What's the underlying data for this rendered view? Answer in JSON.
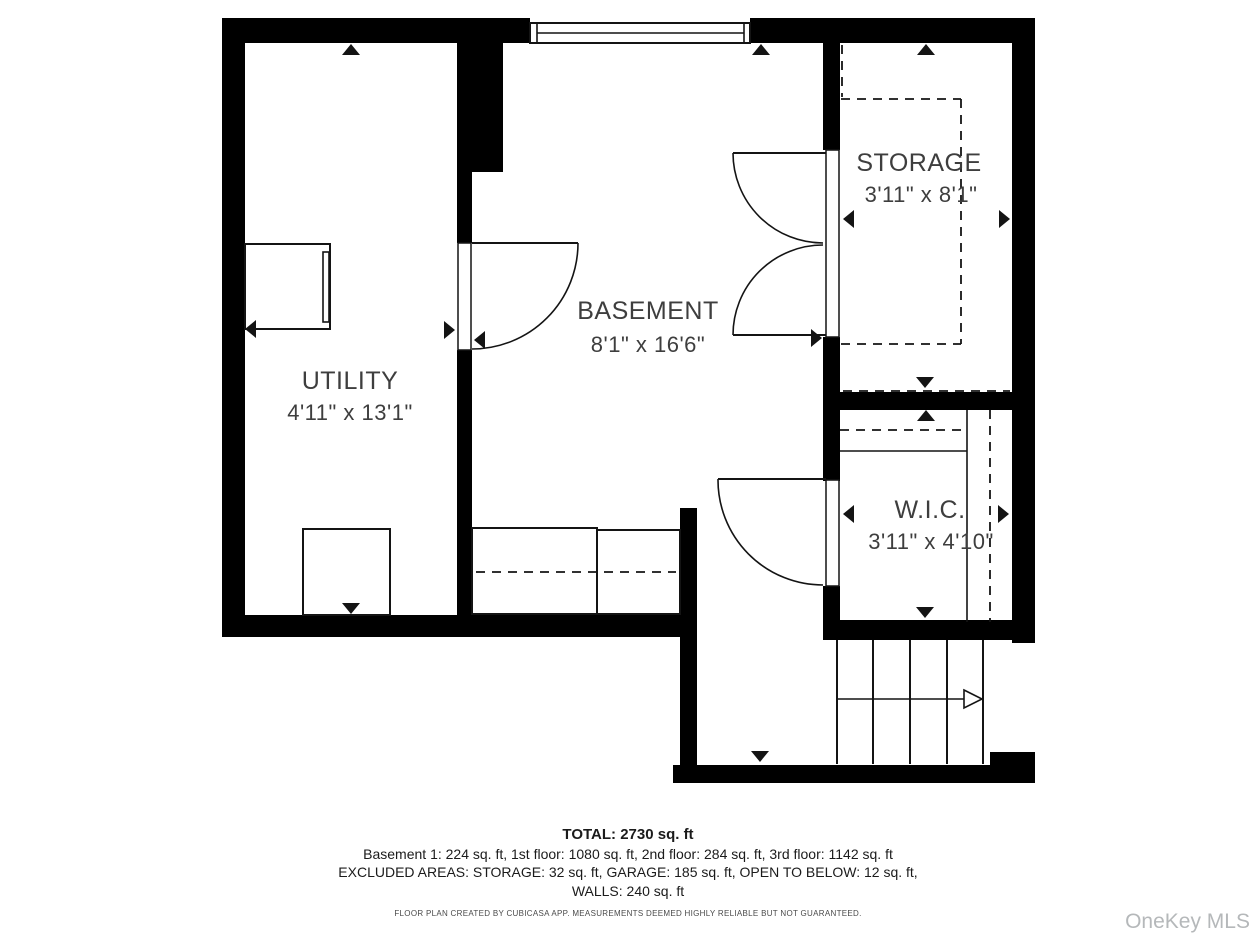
{
  "plan": {
    "floor_name": "Basement 1",
    "rooms": [
      {
        "id": "utility",
        "name": "UTILITY",
        "dimensions": "4'11\" x 13'1\""
      },
      {
        "id": "basement",
        "name": "BASEMENT",
        "dimensions": "8'1\" x 16'6\""
      },
      {
        "id": "storage",
        "name": "STORAGE",
        "dimensions": "3'11\" x 8'1\""
      },
      {
        "id": "wic",
        "name": "W.I.C.",
        "dimensions": "3'11\" x 4'10\""
      }
    ]
  },
  "summary": {
    "total": "TOTAL: 2730 sq. ft",
    "floors": "Basement 1: 224 sq. ft, 1st floor: 1080 sq. ft, 2nd floor: 284 sq. ft, 3rd floor: 1142 sq. ft",
    "excluded": "EXCLUDED AREAS: STORAGE: 32 sq. ft, GARAGE: 185 sq. ft, OPEN TO BELOW: 12 sq. ft,",
    "walls_line": "WALLS: 240 sq. ft"
  },
  "disclaimer": "FLOOR PLAN CREATED BY CUBICASA APP. MEASUREMENTS DEEMED HIGHLY RELIABLE BUT NOT GUARANTEED.",
  "watermark": "OneKey MLS",
  "colors": {
    "wall": "#000000",
    "line": "#141414",
    "text": "#3e3e3e",
    "watermark": "#b5b8ba"
  }
}
